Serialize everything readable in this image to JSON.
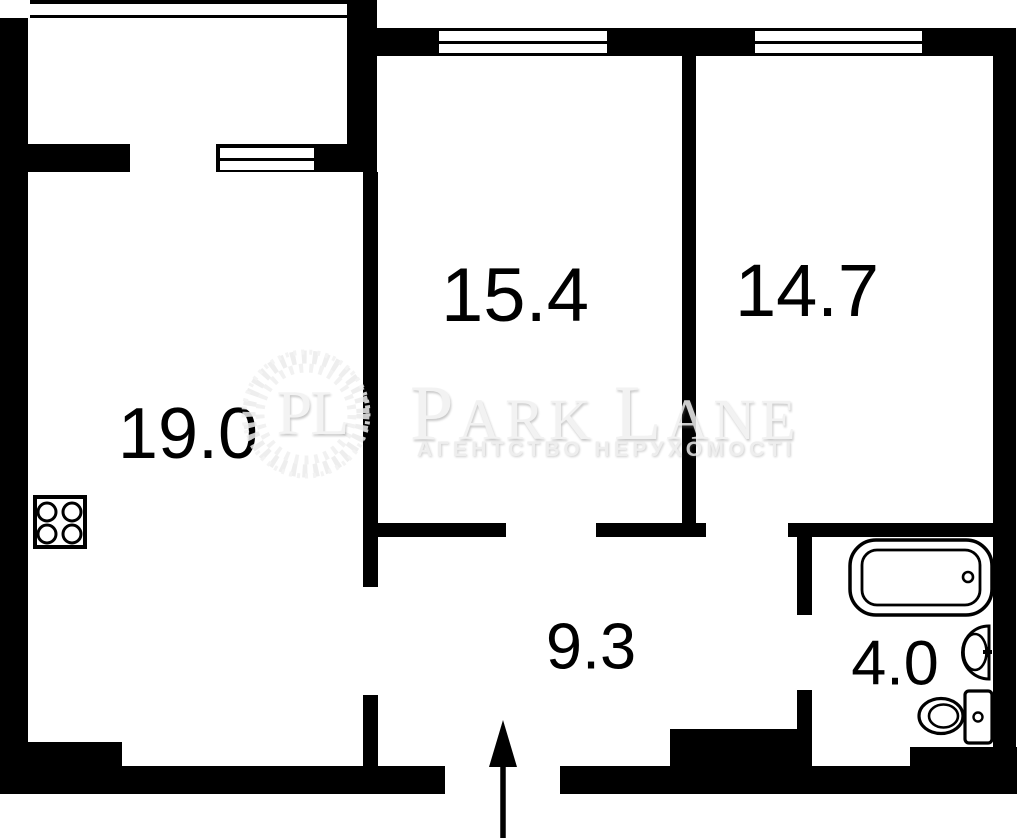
{
  "floorplan": {
    "rooms": [
      {
        "id": "living-room",
        "area": "19.0"
      },
      {
        "id": "bedroom-1",
        "area": "15.4"
      },
      {
        "id": "bedroom-2",
        "area": "14.7"
      },
      {
        "id": "hallway",
        "area": "9.3"
      },
      {
        "id": "bathroom",
        "area": "4.0"
      }
    ],
    "fixtures": [
      "stove-icon",
      "bathtub-icon",
      "sink-icon",
      "toilet-icon",
      "entrance-arrow-icon"
    ],
    "features": [
      "balcony-window",
      "bedroom-1-window",
      "bedroom-2-window",
      "entrance-opening"
    ],
    "colors": {
      "wall": "#000000",
      "background": "#ffffff",
      "fixture_stroke": "#000000"
    }
  },
  "watermark": {
    "monogram": "PL",
    "brand_parts": [
      "P",
      "ARK",
      "L",
      "ANE"
    ],
    "subtitle": "АГЕНТСТВО НЕРУХОМОСТІ",
    "color": "#f0f0f0"
  }
}
